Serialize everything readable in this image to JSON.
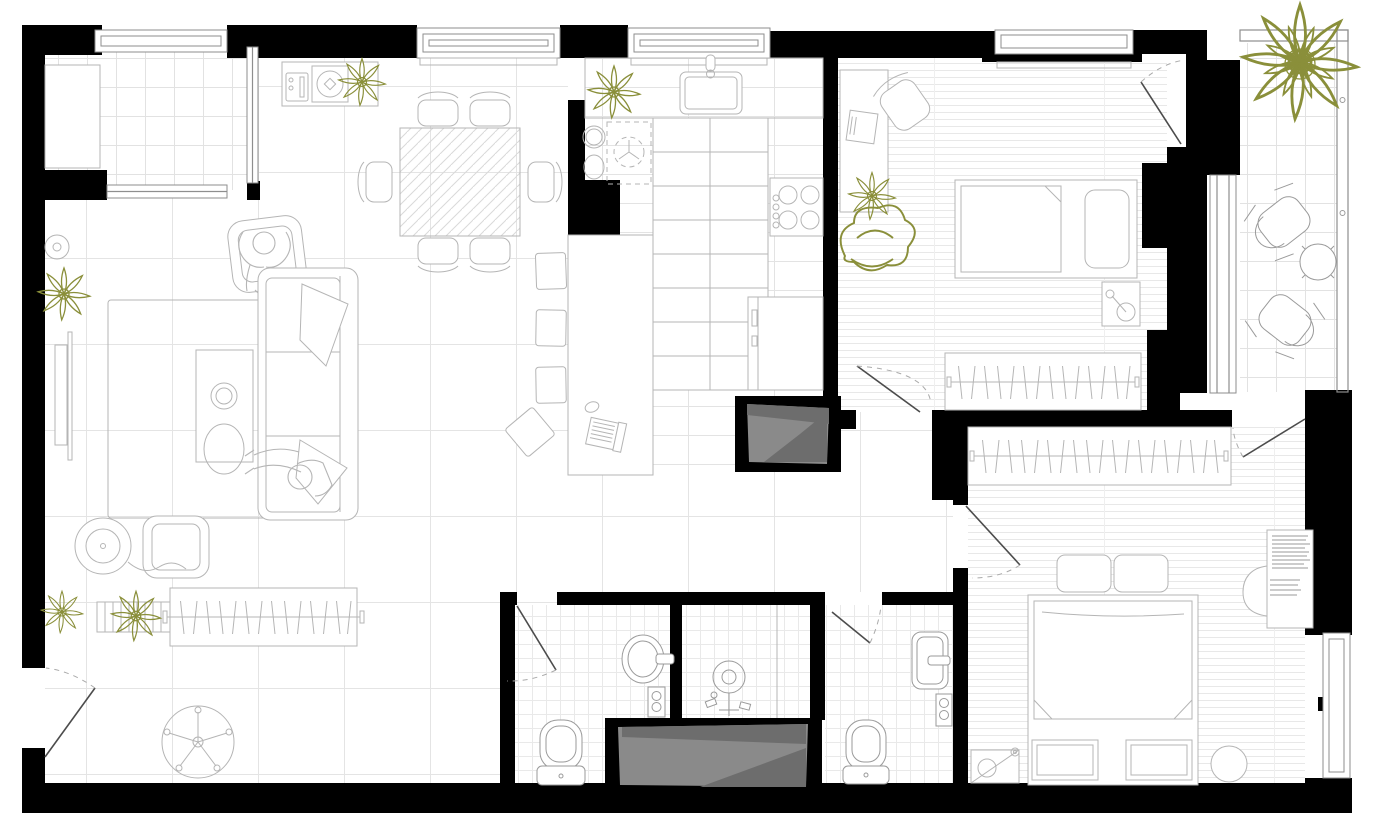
{
  "meta": {
    "title": "Apartment floor plan — top-down architectural drawing",
    "type": "architectural-floor-plan",
    "view": "top-down",
    "style": "black walls, thin gray furniture linework, olive plants, gray service shafts"
  },
  "palette": {
    "wall": "#000000",
    "line": "#b5b5b5",
    "lineDark": "#9a9a9a",
    "frame": "#8e8e8e",
    "door": "#4c4c4c",
    "plant": "#8a8f3a",
    "shaft": "#8a8a8a",
    "shaftDark": "#6d6d6d",
    "floorLine": "#e4e4e4",
    "paper": "#ffffff"
  },
  "rooms": [
    {
      "name": "winter garden loggia",
      "floor": "ceramic tile grid",
      "furniture": [
        "storage cabinet",
        "window band",
        "interior glazing to living room"
      ]
    },
    {
      "name": "living and dining room",
      "floor": "large tile grid",
      "furniture": [
        "sideboard with turntable and radio",
        "potted plant",
        "dining table (wood hatch)",
        "six dining chairs",
        "armchair with seated person reading",
        "area rug",
        "media coffee table with two speakers",
        "three-seat sofa with throw blankets",
        "person lounging on sofa",
        "lounge chair",
        "floor record player with cable",
        "leaning mirror",
        "flower vase",
        "slatted coat bench with plants",
        "open clothes rail with hangers",
        "pedestal fan"
      ]
    },
    {
      "name": "kitchen",
      "floor": "plank-tile lines",
      "furniture": [
        "counter with rectangular sink and tap",
        "two prep bowls",
        "hidden appliance (dashed projection)",
        "tall worktop run",
        "four-burner hob with knobs",
        "refrigerator",
        "island table with laptop and mouse",
        "three square bar stools",
        "one turned bar stool",
        "potted plant"
      ]
    },
    {
      "name": "bedroom one",
      "floor": "wood planks",
      "furniture": [
        "desk with laptop",
        "swivel chair",
        "single bed with pillow and folded duvet",
        "nightstand with reading lamp",
        "built-in wardrobe with hangers",
        "potted flower",
        "leafy plant"
      ]
    },
    {
      "name": "bedroom two",
      "floor": "wood planks",
      "furniture": [
        "double bed with two pillows",
        "folded duvet corners",
        "two foot benches",
        "round pouf",
        "floor lamp",
        "vanity desk with book stacks",
        "half-round chair",
        "built-in wardrobe with hangers"
      ]
    },
    {
      "name": "bathroom one",
      "floor": "fine tile grid",
      "furniture": [
        "oval washbasin with tap",
        "wall control panel",
        "toilet with cistern"
      ]
    },
    {
      "name": "shower room",
      "floor": "fine tile grid",
      "furniture": [
        "rain shower head with riser and valves",
        "glass partition",
        "service shaft (gray)"
      ]
    },
    {
      "name": "bathroom two",
      "floor": "fine tile grid",
      "furniture": [
        "rectangular washbasin with tap",
        "wall control panel",
        "toilet with cistern"
      ]
    },
    {
      "name": "balcony",
      "floor": "ceramic tile grid",
      "furniture": [
        "large potted plant",
        "two folding chairs",
        "round bistro table",
        "glass railing with fittings"
      ]
    },
    {
      "name": "hallway",
      "floor": "large tile grid",
      "furniture": [
        "entry door with swing arc"
      ]
    }
  ],
  "features": {
    "windows": [
      "loggia top window",
      "dining window",
      "kitchen window",
      "bedroom one window",
      "tall narrow glazing to balcony",
      "bedroom two side window"
    ],
    "doors": [
      "entry door",
      "bathroom one door",
      "bathroom two door",
      "bedroom one door",
      "bedroom two hall door",
      "bedroom two wardrobe-side door",
      "bedroom one balcony door"
    ],
    "shafts": [
      "kitchen ventilation shaft",
      "bathroom ventilation shaft"
    ],
    "people": [
      {
        "location": "armchair",
        "activity": "sitting, reading"
      },
      {
        "location": "sofa",
        "activity": "lounging"
      }
    ]
  }
}
